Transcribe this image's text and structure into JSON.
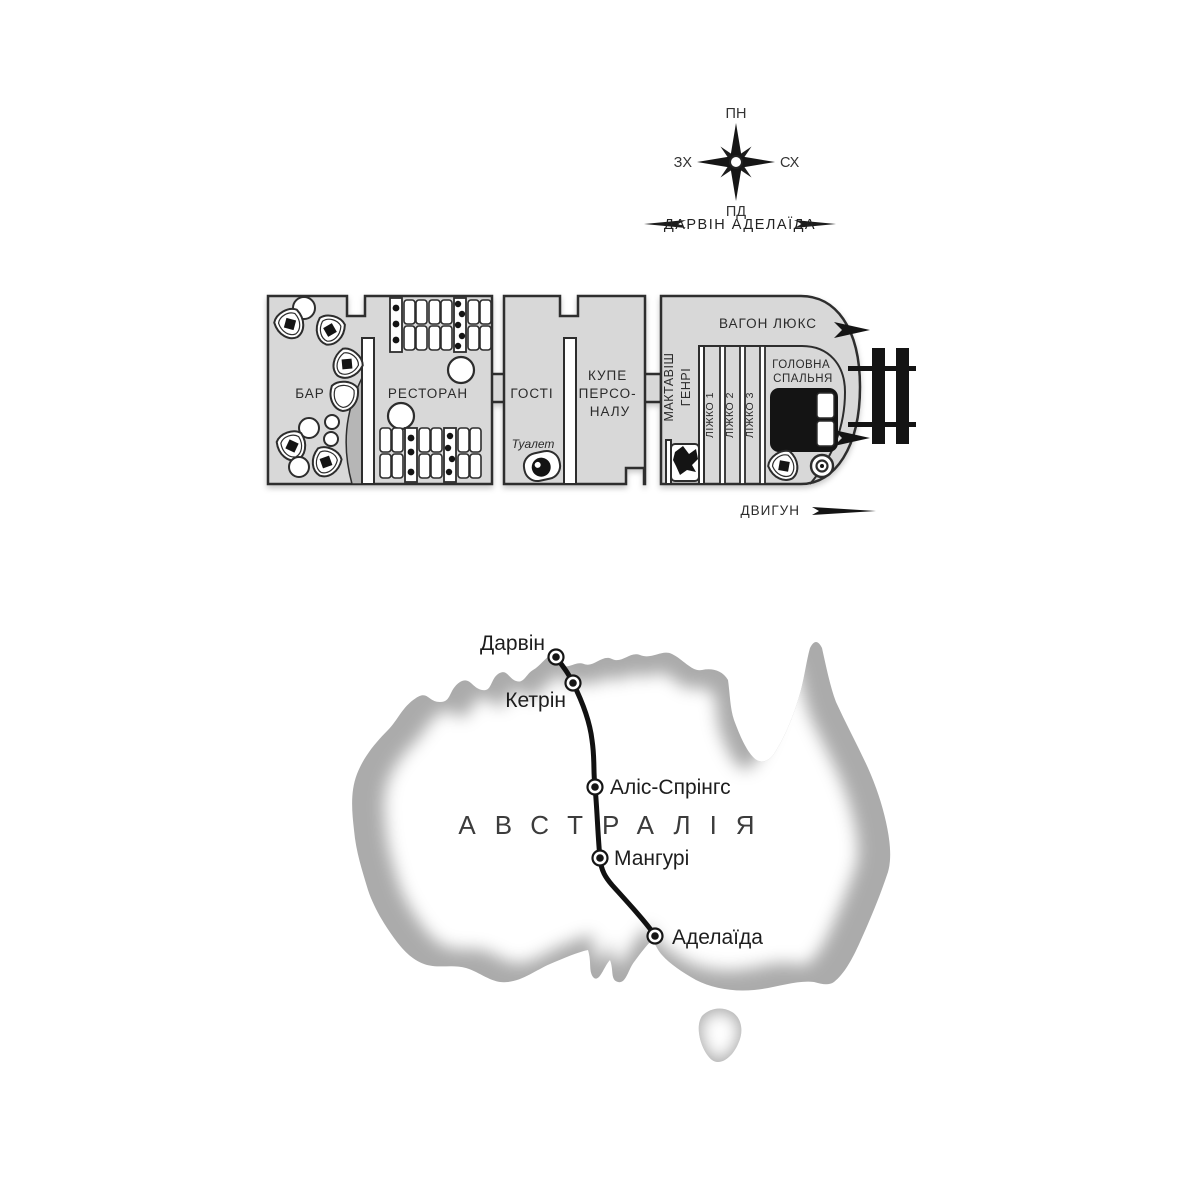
{
  "compass": {
    "north": "ПН",
    "east": "СХ",
    "south": "ПД",
    "west": "ЗХ"
  },
  "route_banner": {
    "text": "ДАРВІН АДЕЛАЇДА"
  },
  "train": {
    "rooms": {
      "bar": "БАР",
      "restaurant": "РЕСТОРАН",
      "guests": "ГОСТІ",
      "staff_compartment": [
        "КУПЕ",
        "ПЕРСО-",
        "НАЛУ"
      ],
      "mctavish": [
        "ГЕНРІ",
        "МАКТАВІШ"
      ],
      "lux_car": "ВАГОН ЛЮКС",
      "berth1": "ЛІЖКО 1",
      "berth2": "ЛІЖКО 2",
      "berth3": "ЛІЖКО 3",
      "master_bedroom": [
        "ГОЛОВНА",
        "СПАЛЬНЯ"
      ],
      "toilet": "Туалет"
    },
    "engine_label": "ДВИГУН"
  },
  "map": {
    "country": "АВСТРАЛІЯ",
    "stations": [
      {
        "name": "Дарвін"
      },
      {
        "name": "Кетрін"
      },
      {
        "name": "Аліс-Спрінгс"
      },
      {
        "name": "Мангурі"
      },
      {
        "name": "Аделаїда"
      }
    ]
  },
  "icons": {
    "compass_rose": "8-point star with N/E/S/W labels",
    "direction_arrows": "long tapered left/right darts",
    "railway_track": "two rails with two ties",
    "coupling_arrows": "black darts at car nose",
    "toilet": "top-view toilet bowl",
    "double_bed": "black bed with two white pillows",
    "single_bed": "bed with crumpled black blanket",
    "armchair": "round tub chair with black cushion",
    "engine_arrow": "tapered right-pointing dart"
  },
  "colors": {
    "background": "#ffffff",
    "train_fill": "#d8d8d8",
    "bar_counter": "#b6b6b6",
    "outline": "#2d2d2d",
    "ink": "#141414",
    "map_fill": "#ababab"
  }
}
